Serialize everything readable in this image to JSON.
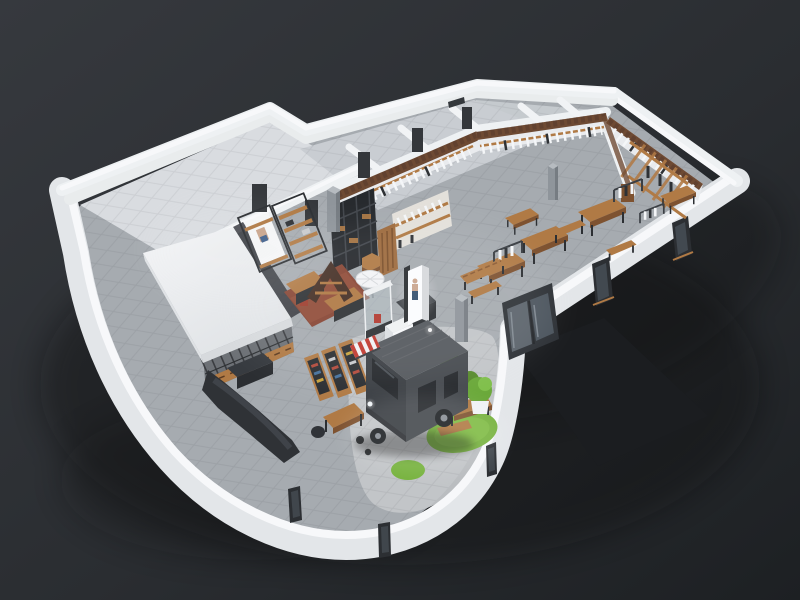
{
  "meta": {
    "type": "3d-architectural-render",
    "subject": "Isometric cutaway 3D floor plan of a retail clothing store with an indoor food truck cafe corner",
    "view": "aerial three-quarter, walls cut at constant height",
    "canvas": {
      "width": 800,
      "height": 600
    }
  },
  "palette": {
    "bg_top": "#34373c",
    "bg_bot": "#1e2124",
    "wall_top": "#f7f8fa",
    "wall_face": "#e3e6e9",
    "wall_inner": "#eef1f3",
    "floor_main": "#a6abb0",
    "floor_room": "#d9dce0",
    "floor_strip": "#c9cdd2",
    "floor_light": "#c3c6c9",
    "canopy": "#eef0f2",
    "wood": "#b07a45",
    "wood_dark": "#7e5230",
    "brick": "#6e4a33",
    "metal": "#2c2f33",
    "sofa": "#2f3236",
    "truck_top": "#54585d",
    "truck_side": "#45494e",
    "truck_front": "#3a3e43",
    "glass": "#5b636b",
    "grass": "#76b23d",
    "rug": "#884634",
    "red": "#c0392f",
    "clothes": "#f4f6f8",
    "ramp": "#1b1e21",
    "pillar": "#8f959b"
  },
  "scene": {
    "background": "dark charcoal studio backdrop with soft ground shadow",
    "building": {
      "plan": "bent L-shape; right showroom wing, back service rooms, empty back-left room, rounded front lobby corner",
      "walls": "white cutaway walls",
      "floor": "grey concrete tile showroom floor, pale paver courtyard"
    },
    "zones": [
      {
        "id": "back-left-room",
        "label": "Empty back-left storage room"
      },
      {
        "id": "back-rooms",
        "label": "Row of small back offices with dark door openings"
      },
      {
        "id": "central-showroom",
        "label": "Central showroom with shelving and displays"
      },
      {
        "id": "right-wing",
        "label": "Right showroom wing with wall-hung clothing"
      },
      {
        "id": "courtyard",
        "label": "Rounded front corner with food-truck cafe"
      }
    ],
    "objects": [
      {
        "id": "canopy-room",
        "label": "White flat canopy over glass-walled fitting room"
      },
      {
        "id": "glass-partition",
        "label": "Black framed glazed partition with wood cabinets"
      },
      {
        "id": "sofa",
        "label": "Long charcoal sofa along curved wall"
      },
      {
        "id": "magazine-racks",
        "label": "Three wooden magazine display racks"
      },
      {
        "id": "writing-desk",
        "label": "Wooden desk with chair"
      },
      {
        "id": "display-shelf-units",
        "label": "Metal frame shelf units with poster panel"
      },
      {
        "id": "black-bookcase",
        "label": "Tall black grid bookcase"
      },
      {
        "id": "wood-slat-cabinet",
        "label": "Vertical wood slat cabinet"
      },
      {
        "id": "hex-table",
        "label": "Hexagonal wood display table"
      },
      {
        "id": "area-rug",
        "label": "Rust red area rug with display tables"
      },
      {
        "id": "a-frame-display",
        "label": "A-frame ladder display"
      },
      {
        "id": "parasol",
        "label": "White cafe parasol"
      },
      {
        "id": "glass-display-case",
        "label": "Glass display tower"
      },
      {
        "id": "checkout-counter",
        "label": "Dark checkout counter with white promo cube"
      },
      {
        "id": "lightbox",
        "label": "Illuminated poster lightbox"
      },
      {
        "id": "concrete-pillars",
        "label": "Concrete columns"
      },
      {
        "id": "food-truck",
        "label": "Charcoal grey food truck with red-white striped awning"
      },
      {
        "id": "grass-patches",
        "label": "Round artificial grass patches"
      },
      {
        "id": "picnic-table",
        "label": "Wooden picnic table and bench"
      },
      {
        "id": "potted-plants",
        "label": "Potted shrubs and leafy plant"
      },
      {
        "id": "entrance-doors",
        "label": "Glazed entrance sliding doors"
      },
      {
        "id": "entry-ramp",
        "label": "Dark entry pavement outside doors"
      },
      {
        "id": "clothing-walls",
        "label": "Brick-trimmed walls with hung white garments"
      },
      {
        "id": "wooden-frame-rack",
        "label": "Large wooden frame clothing rack"
      },
      {
        "id": "showroom-tables",
        "label": "Wooden display tables and benches"
      },
      {
        "id": "clothing-racks",
        "label": "Freestanding garment rails"
      },
      {
        "id": "windows",
        "label": "Narrow window slits in outer walls"
      }
    ]
  }
}
